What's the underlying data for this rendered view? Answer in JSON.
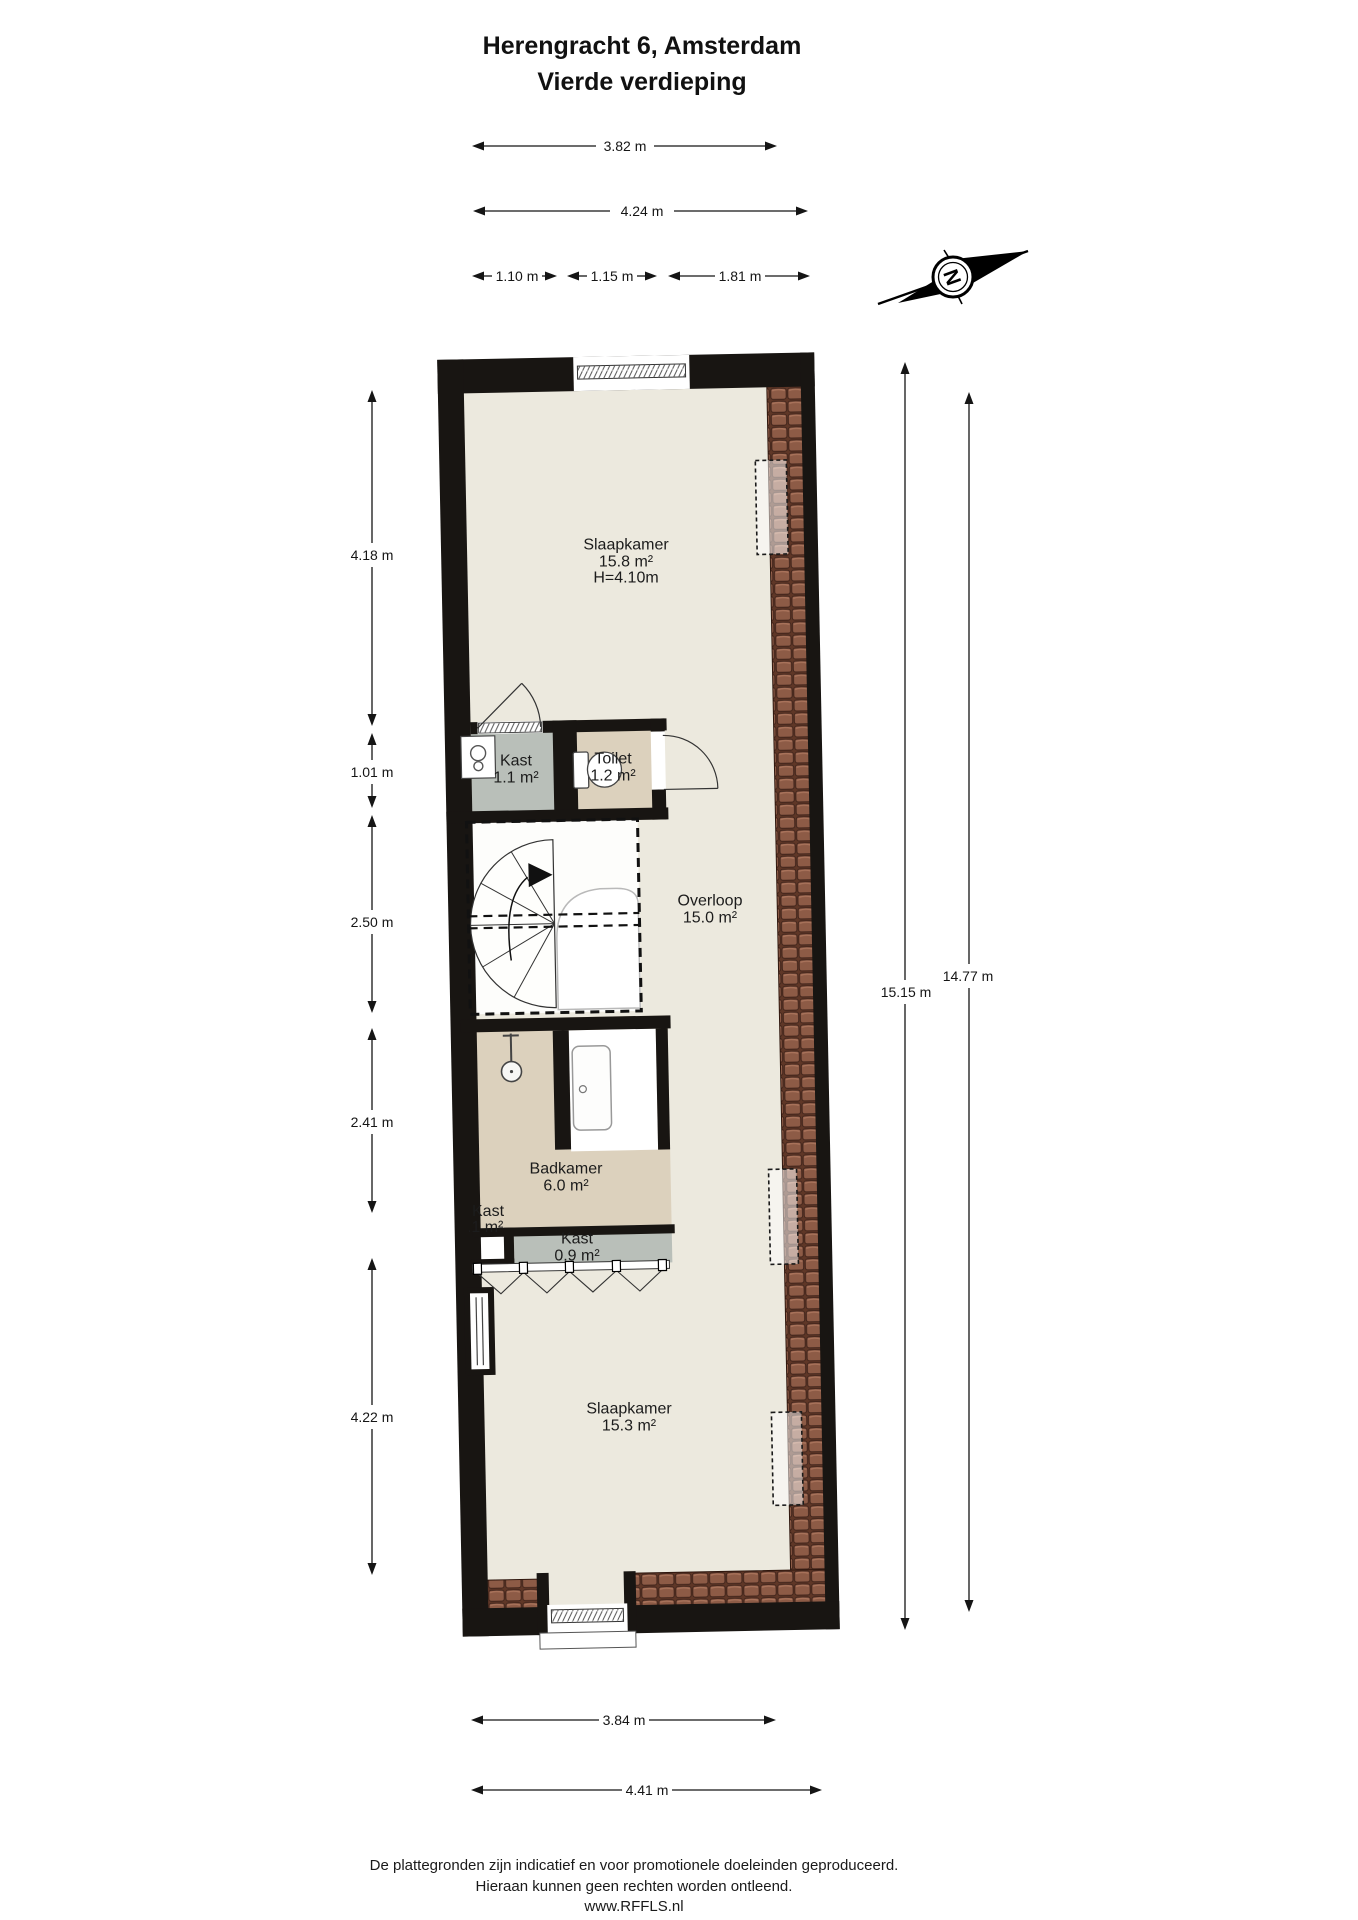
{
  "title": {
    "line1": "Herengracht 6, Amsterdam",
    "line2": "Vierde verdieping"
  },
  "compass": {
    "letter": "N"
  },
  "dims": {
    "top": [
      "3.82 m",
      "4.24 m",
      "1.10 m",
      "1.15 m",
      "1.81 m"
    ],
    "left": [
      "4.18 m",
      "1.01 m",
      "2.50 m",
      "2.41 m",
      "4.22 m"
    ],
    "right": [
      "15.15 m",
      "14.77 m"
    ],
    "bottom": [
      "3.84 m",
      "4.41 m"
    ]
  },
  "rooms": {
    "slaapkamer_top": {
      "name": "Slaapkamer",
      "area": "15.8 m²",
      "height": "H=4.10m"
    },
    "kast_boiler": {
      "name": "Kast",
      "area": "1.1 m²"
    },
    "toilet": {
      "name": "Toilet",
      "area": "1.2 m²"
    },
    "overloop": {
      "name": "Overloop",
      "area": "15.0 m²"
    },
    "badkamer": {
      "name": "Badkamer",
      "area": "6.0 m²"
    },
    "kast_klein": {
      "name": "Kast",
      "area": "0.1 m²"
    },
    "kast_vouwdeuren": {
      "name": "Kast",
      "area": "0.9 m²"
    },
    "slaapkamer_onder": {
      "name": "Slaapkamer",
      "area": "15.3 m²"
    }
  },
  "footer": {
    "line1": "De plattegronden zijn indicatief en voor promotionele doeleinden geproduceerd.",
    "line2": "Hieraan kunnen geen rechten worden ontleend.",
    "line3": "www.RFFLS.nl"
  },
  "colors": {
    "wall": "#181512",
    "floor": "#ece9de",
    "wet_floor": "#dcd1bd",
    "closet_floor": "#b9bfb9",
    "roof_tile": "#8d5b46",
    "stairs_floor": "#fdfdfb"
  }
}
